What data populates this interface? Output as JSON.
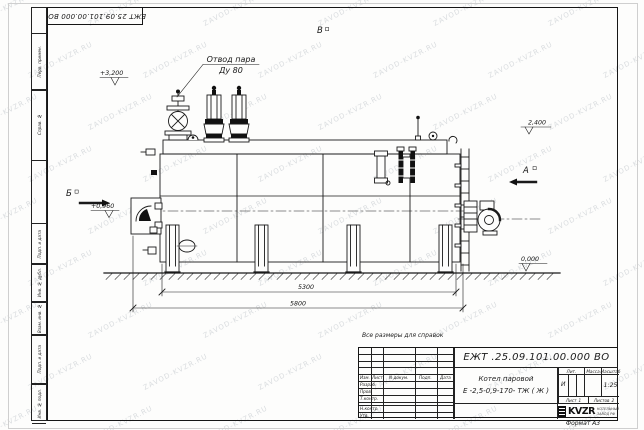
{
  "sheet": {
    "format_note": "Формат А3",
    "reference_note": "Все размеры для справок",
    "watermark_text": "ZAVOD-KVZR.RU"
  },
  "doc": {
    "designation_top": "ЕЖТ 25.09.101.00.000 ВО",
    "designation": "ЕЖТ .25.09.101.00.000  ВО",
    "product_line1": "Котел паровой",
    "product_line2": "Е -2,5-0,9-170- ТЖ ( Ж )"
  },
  "left_strip": [
    "Перв. примен.",
    "Справ. №",
    "Подп. и дата",
    "Инв. № дубл.",
    "Взам. инв. №",
    "Подп. и дата",
    "Инв. № подл."
  ],
  "title_block": {
    "cols": {
      "izm": "Изм.",
      "list": "Лист",
      "ndoc": "N докум.",
      "podp": "Подп.",
      "data": "Дата"
    },
    "rows": {
      "razrab": "Разраб.",
      "prov": "Пров.",
      "tkontr": "Т.контр.",
      "nkontr": "Н.контр.",
      "utv": "Утв."
    },
    "lit_label": "Лит.",
    "lit_value": "И",
    "mass_label": "Масса",
    "scale_label": "Масштаб",
    "scale_value": "1:25",
    "sheet_label": "Лист",
    "sheet_value": "1",
    "sheets_label": "Листов",
    "sheets_value": "2",
    "logo_text": "KVZR",
    "company_line1": "КОТЕЛЬНЫЙ",
    "company_line2": "ЗАВОД РФ"
  },
  "annotations": {
    "steam_outlet_line1": "Отвод пара",
    "steam_outlet_line2": "Ду 80",
    "elev_top": "+3,200",
    "elev_right": "2,400",
    "elev_left": "+0,960",
    "elev_zero": "0,000",
    "dim_inner": "5300",
    "dim_outer": "5800",
    "view_a": "А",
    "view_b": "Б",
    "view_v": "В"
  }
}
